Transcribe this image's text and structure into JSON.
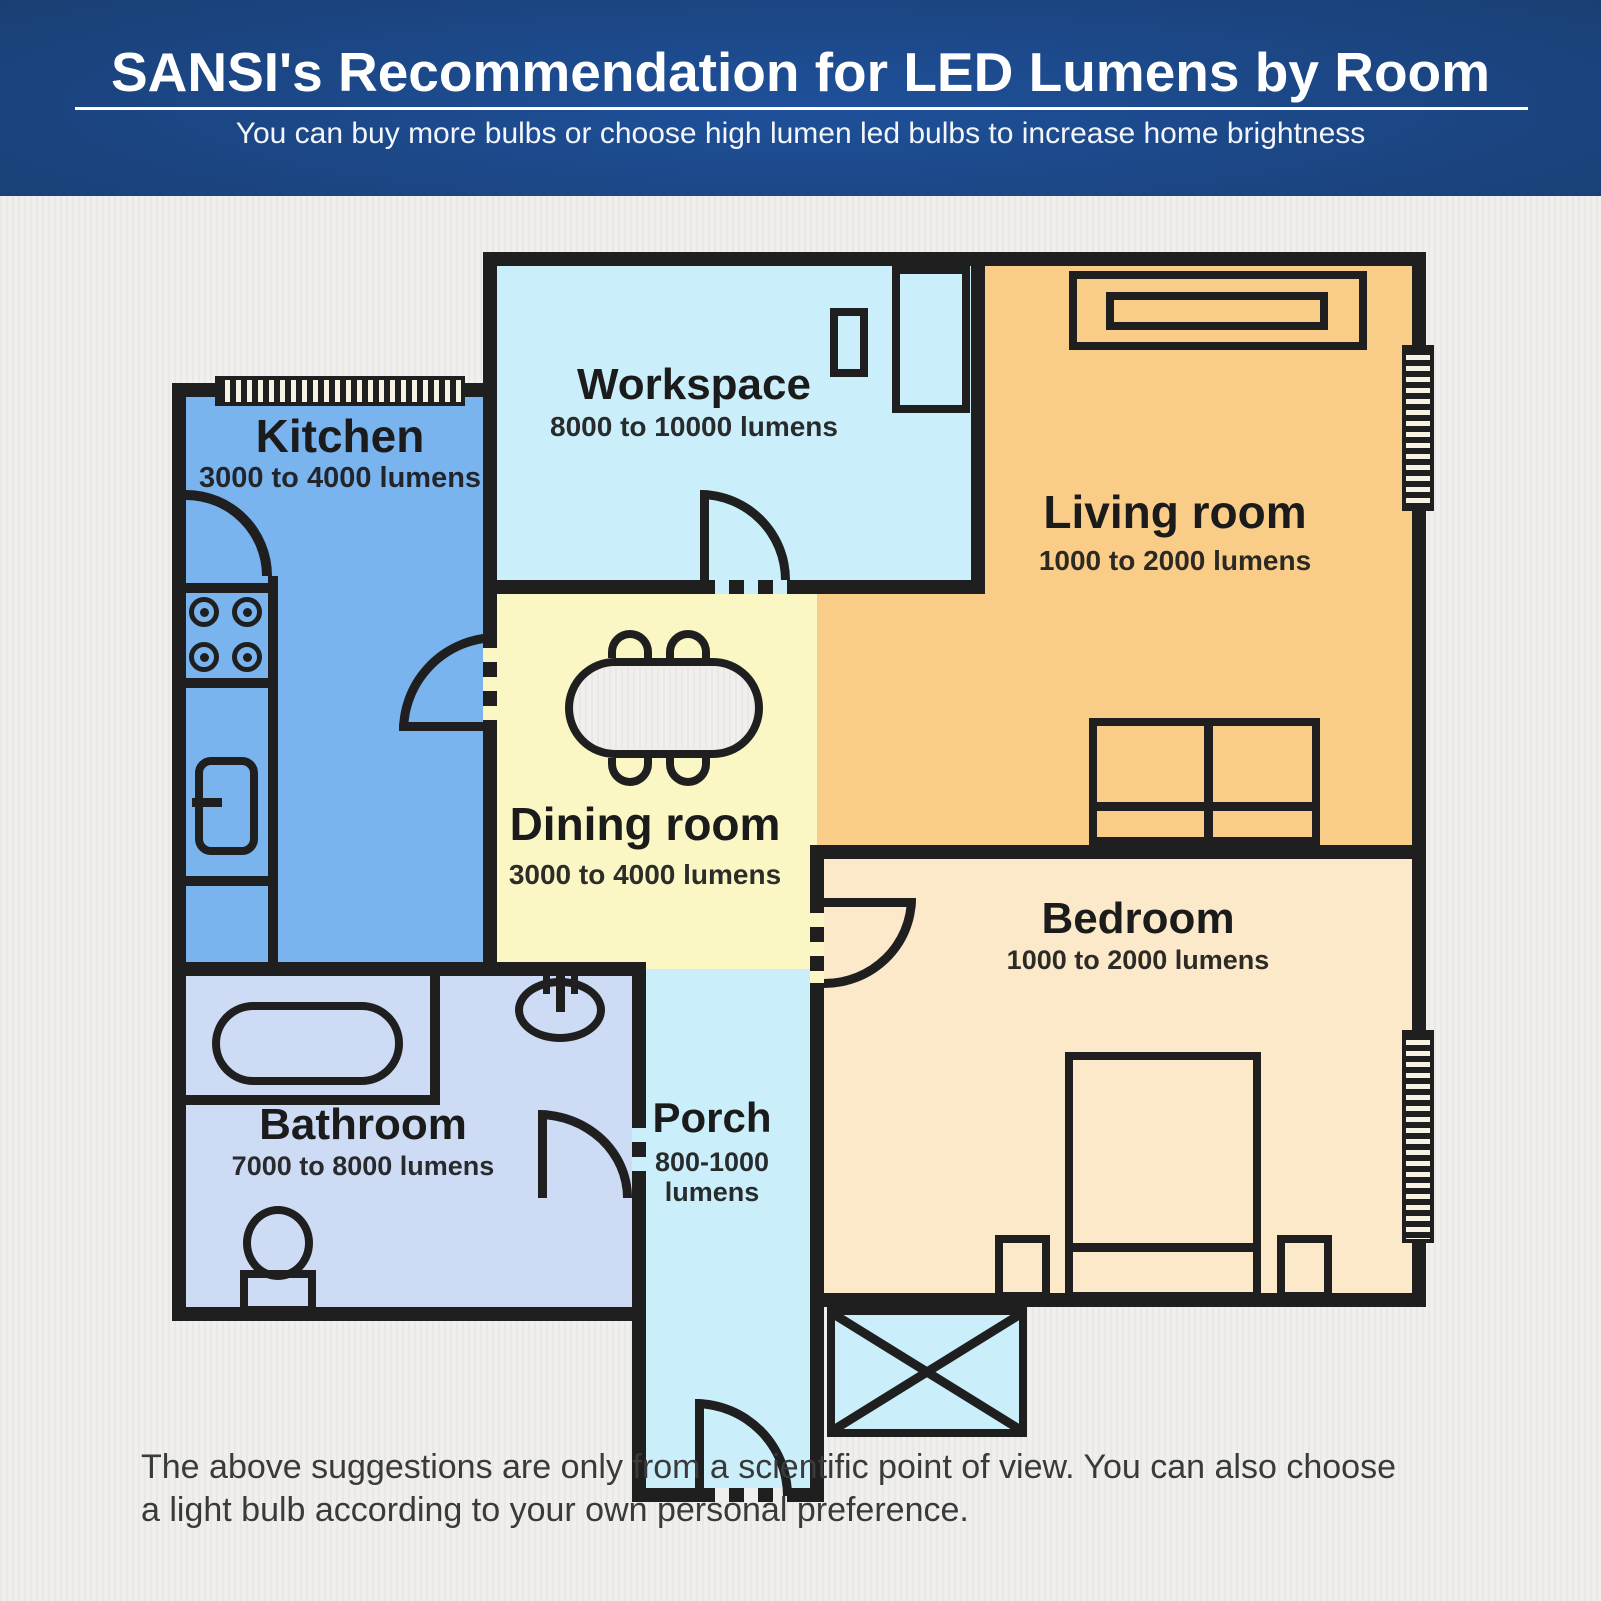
{
  "header": {
    "title": "SANSI's Recommendation for LED Lumens by Room",
    "subtitle": "You can buy more bulbs or choose high lumen led bulbs to increase home brightness"
  },
  "rooms": {
    "kitchen": {
      "name": "Kitchen",
      "lumens": "3000 to 4000 lumens",
      "color": "#7ab4ef"
    },
    "workspace": {
      "name": "Workspace",
      "lumens": "8000 to 10000 lumens",
      "color": "#cbeefb"
    },
    "living": {
      "name": "Living room",
      "lumens": "1000 to 2000 lumens",
      "color": "#f9cc87"
    },
    "dining": {
      "name": "Dining room",
      "lumens": "3000 to 4000 lumens",
      "color": "#fbf7c5"
    },
    "bedroom": {
      "name": "Bedroom",
      "lumens": "1000 to 2000 lumens",
      "color": "#fce9c9"
    },
    "bathroom": {
      "name": "Bathroom",
      "lumens": "7000 to 8000 lumens",
      "color": "#cedbf5"
    },
    "porch": {
      "name": "Porch",
      "lumens_line1": "800-1000",
      "lumens_line2": "lumens",
      "color": "#cbeefb"
    }
  },
  "palette": {
    "wall": "#1f1f1f",
    "page_background": "#f0efed",
    "header_blue_dark": "#112a4d",
    "header_blue_light": "#1e509a",
    "text_dark": "#1b1b1b"
  },
  "footer": {
    "line1": "The above suggestions are only from a scientific point of view. You can also choose",
    "line2": "a light bulb according to your own personal preference."
  }
}
